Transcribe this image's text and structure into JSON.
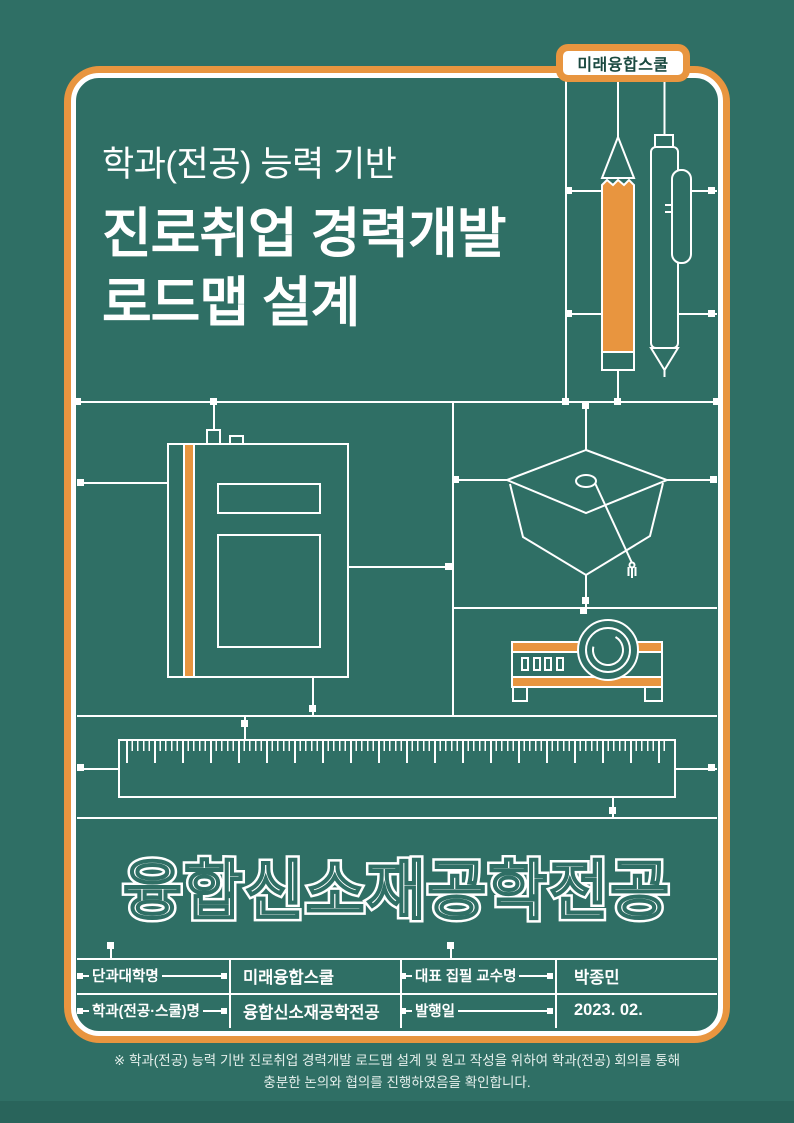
{
  "badge": {
    "label": "미래융합스쿨"
  },
  "header": {
    "subtitle": "학과(전공) 능력 기반",
    "title_line1": "진로취업 경력개발",
    "title_line2": "로드맵 설계"
  },
  "major_title": {
    "text": "융합신소재공학전공"
  },
  "info_table": {
    "rows": [
      {
        "label1": "단과대학명",
        "value1": "미래융합스쿨",
        "label2": "대표 집필 교수명",
        "value2": "박종민"
      },
      {
        "label1": "학과(전공·스쿨)명",
        "value1": "융합신소재공학전공",
        "label2": "발행일",
        "value2": "2023. 02."
      }
    ]
  },
  "footer": {
    "line1": "※ 학과(전공) 능력 기반 진로취업 경력개발 로드맵 설계 및 원고 작성을 위하여 학과(전공)  회의를 통해",
    "line2": "충분한 논의와 협의를 진행하였음을 확인합니다."
  },
  "icons": {
    "pencil": "pencil-icon",
    "pen": "pen-icon",
    "notebook": "notebook-icon",
    "graduation_cap": "graduation-cap-icon",
    "projector": "projector-icon",
    "ruler": "ruler-icon"
  },
  "colors": {
    "background": "#2F6F65",
    "accent_orange": "#E8953F",
    "line_white": "#FFFFFF",
    "badge_text": "#1A4940",
    "footer_band": "#29645B"
  }
}
